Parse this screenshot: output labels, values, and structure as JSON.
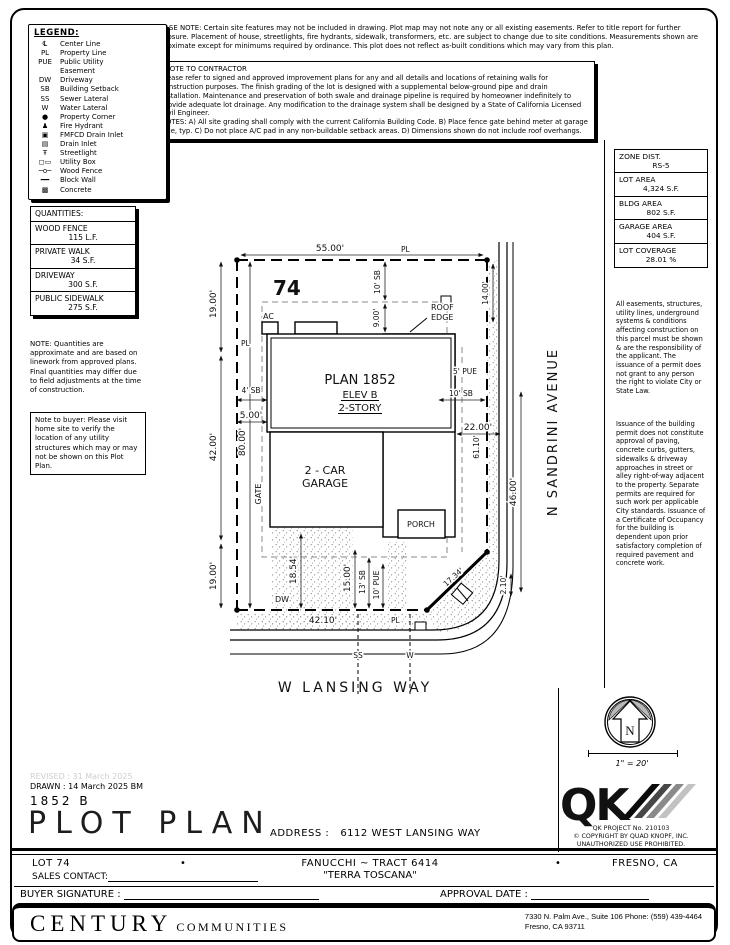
{
  "top_note": "PLEASE NOTE:  Certain site features may not be included in drawing.  Plot map may not note any or all existing easements.  Refer to title report for further disclosure.  Placement of house, streetlights, fire hydrants, sidewalk, transformers, etc. are subject to change due to site conditions.  Measurements shown are approximate except for minimums required by ordinance.  This plot does not reflect as-built conditions which may vary from this plan.",
  "contractor": {
    "title": "*NOTE TO CONTRACTOR",
    "body": "Please refer to signed and approved improvement plans for any and all details and locations of retaining walls for construction purposes. The finish grading of the lot is designed with a supplemental below-ground pipe and drain installation.  Maintenance and preservation of both swale and drainage pipeline is required by homeowner indefinitely to provide adequate lot drainage.  Any modification to the drainage system shall be designed by a State of California Licensed Civil Engineer.",
    "notes": "NOTES:  A) All site grading shall comply with the current California Building Code.  B) Place fence gate behind meter at garage side, typ.  C) Do not place A/C pad in any non-buildable setback areas.  D) Dimensions shown do not include roof overhangs."
  },
  "legend": {
    "title": "LEGEND:",
    "items": [
      {
        "icon": "℄",
        "label": "Center Line"
      },
      {
        "icon": "PL",
        "label": "Property Line"
      },
      {
        "icon": "PUE",
        "label": "Public Utility\nEasement"
      },
      {
        "icon": "DW",
        "label": "Driveway"
      },
      {
        "icon": "SB",
        "label": "Building Setback"
      },
      {
        "icon": "SS",
        "label": "Sewer Lateral"
      },
      {
        "icon": "W",
        "label": "Water Lateral"
      },
      {
        "icon": "●",
        "label": "Property Corner"
      },
      {
        "icon": "♟",
        "label": "Fire Hydrant"
      },
      {
        "icon": "▣",
        "label": "FMFCD Drain Inlet"
      },
      {
        "icon": "▤",
        "label": "Drain Inlet"
      },
      {
        "icon": "Ŧ",
        "label": "Streetlight"
      },
      {
        "icon": "◻▭",
        "label": "Utility Box"
      },
      {
        "icon": "─o─",
        "label": "Wood Fence"
      },
      {
        "icon": "━━",
        "label": "Block Wall"
      },
      {
        "icon": "▩",
        "label": "Concrete"
      }
    ]
  },
  "quantities": {
    "title": "QUANTITIES:",
    "items": [
      {
        "name": "WOOD FENCE",
        "value": "115 L.F."
      },
      {
        "name": "PRIVATE WALK",
        "value": "34 S.F."
      },
      {
        "name": "DRIVEWAY",
        "value": "300 S.F."
      },
      {
        "name": "PUBLIC SIDEWALK",
        "value": "275 S.F."
      }
    ],
    "note": "NOTE: Quantities are approximate and are based on linework from approved plans.  Final quantities may differ due to field adjustments at the time of construction.",
    "buyer_note": "Note to buyer: Please visit home site to verify the location of any utility structures which may or may not be shown on this Plot Plan."
  },
  "site_info": {
    "items": [
      {
        "label": "ZONE DIST.",
        "value": "RS-5"
      },
      {
        "label": "LOT AREA",
        "value": "4,324 S.F."
      },
      {
        "label": "BLDG AREA",
        "value": "802 S.F."
      },
      {
        "label": "GARAGE AREA",
        "value": "404 S.F."
      },
      {
        "label": "LOT COVERAGE",
        "value": "28.01 %"
      }
    ]
  },
  "right_notes": {
    "para1": "All easements, structures, utility lines, underground systems & conditions affecting construction on this parcel must be shown & are the responsibility of the applicant. The issuance of a permit does not grant to any person the right to violate City or State Law.",
    "para2": "Issuance of the building permit does not constitute approval of paving, concrete curbs, gutters, sidewalks & driveway approaches in street or alley right-of-way adjacent to the property. Separate permits are required for such work per applicable City standards. Issuance of a Certificate of Occupancy for the building is dependent upon prior satisfactory completion of required pavement and concrete work."
  },
  "plan": {
    "lot_number": "74",
    "dim_top": "55.00'",
    "pl": "PL",
    "sb10": "10' SB",
    "dim9": "9.00'",
    "ac": "AC",
    "roof1": "ROOF",
    "roof2": "EDGE",
    "plan_name": "PLAN 1852",
    "elev": "ELEV B",
    "story": "2-STORY",
    "sb4": "4' SB",
    "dim5": "5.00'",
    "dim22": "22.00'",
    "dim19a": "19.00'",
    "dim42": "42.00'",
    "dim80": "80.00'",
    "dim19b": "19.00'",
    "garage1": "2 - CAR",
    "garage2": "GARAGE",
    "gate": "GATE",
    "porch": "PORCH",
    "dw": "DW",
    "dim1854": "18.54'",
    "dim15": "15.00'",
    "sb13": "13' SB",
    "pue10": "10' PUE",
    "dim4210": "42.10'",
    "dim1734": "17.34'",
    "dim210": "2.10'",
    "dim6110": "61.10'",
    "dim46": "46.00'",
    "dim14": "14.00'",
    "pue5": "5' PUE",
    "sb10r": "10' SB",
    "street_right": "N SANDRINI AVENUE",
    "street_bottom": "W LANSING WAY",
    "ss": "SS",
    "w": "W"
  },
  "compass": {
    "n": "N",
    "scale": "1\" = 20'"
  },
  "qk": {
    "logo": "QK",
    "project": "QK PROJECT No. 210103",
    "copyright": "©  COPYRIGHT BY QUAD KNOPF, INC.",
    "prohibited": "UNAUTHORIZED USE PROHIBITED."
  },
  "title_block": {
    "revised": "REVISED :  31 March 2025",
    "drawn": "DRAWN :  14 March 2025   BM",
    "plan_no": "1852  B",
    "title": "PLOT PLAN",
    "address_label": "ADDRESS :",
    "address": "6112 WEST LANSING WAY",
    "lot": "LOT 74",
    "bullet": "•",
    "tract": "FANUCCHI ~ TRACT 6414",
    "community": "\"TERRA TOSCANA\"",
    "city": "FRESNO, CA",
    "sales_label": "SALES CONTACT:",
    "buyer_label": "BUYER SIGNATURE :",
    "approval_label": "APPROVAL DATE :"
  },
  "footer": {
    "brand": "CENTURY",
    "brand2": "COMMUNITIES",
    "address1": "7330 N. Palm Ave., Suite 106     Phone:  (559) 439-4464",
    "address2": "Fresno, CA  93711"
  }
}
